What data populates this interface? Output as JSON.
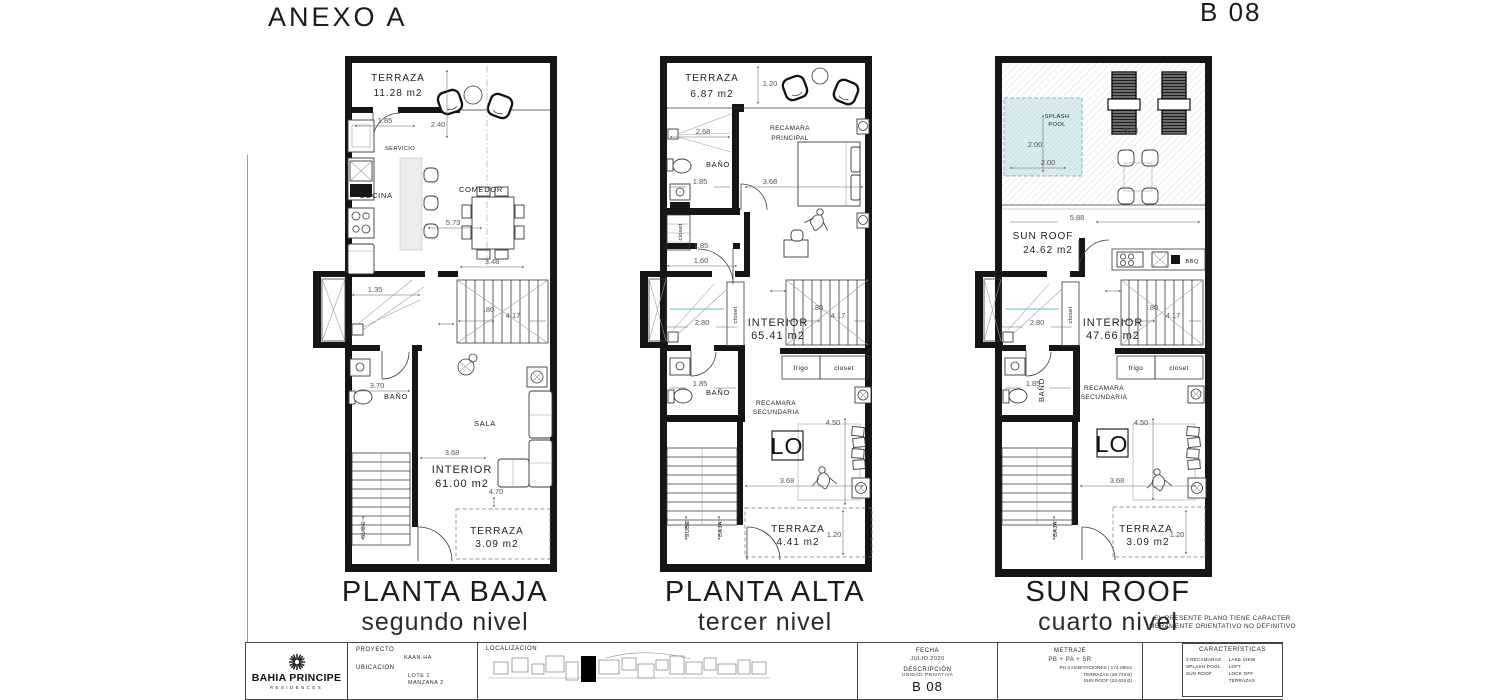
{
  "header": {
    "title": "ANEXO A",
    "unit": "B 08"
  },
  "p1": {
    "title": "PLANTA BAJA",
    "subtitle": "segundo nivel",
    "terraza": "TERRAZA",
    "terraza_area": "11.28 m2",
    "d185": "1.85",
    "d240": "2.40",
    "servicio": "SERVICIO",
    "cocina": "COCINA",
    "comedor": "COMEDOR",
    "d573": "5.73",
    "d348": "3.48",
    "d135": "1.35",
    "d80": ".80",
    "d417": "4.17",
    "d370": "3.70",
    "bano": "BAÑO",
    "sala": "SALA",
    "d368": "3.68",
    "interior": "INTERIOR",
    "interior_area": "61.00 m2",
    "d470": "4.70",
    "terraza2": "TERRAZA",
    "terraza2_area": "3.09 m2",
    "sube": "SUBE"
  },
  "p2": {
    "title": "PLANTA ALTA",
    "subtitle": "tercer nivel",
    "terraza": "TERRAZA",
    "terraza_area": "6.87 m2",
    "d120": "1.20",
    "recamara_a": "RECAMARA",
    "recamara_b": "PRINCIPAL",
    "d268": "2.68",
    "bano": "BAÑO",
    "d185": "1.85",
    "d368": "3.68",
    "closet_v": "closet",
    "d185b": "1.85",
    "d160": "1.60",
    "d280": "2.80",
    "closet_v2": "closet",
    "interior": "INTERIOR",
    "interior_area": "65.41 m2",
    "d80": ".80",
    "d417": "4.17",
    "frigo": "frigo",
    "closet": "closet",
    "d185c": "1.85",
    "bano2": "BAÑO",
    "recamara2_a": "RECAMARA",
    "recamara2_b": "SECUNDARIA",
    "d450": "4.50",
    "lo": "LO",
    "d368b": "3.68",
    "terraza2": "TERRAZA",
    "terraza2_area": "4.41 m2",
    "d120b": "1.20",
    "sube": "SUBE",
    "baja": "BAJA"
  },
  "p3": {
    "title": "SUN ROOF",
    "subtitle": "cuarto nivel",
    "splash_a": "SPLASH",
    "splash_b": "POOL",
    "d200a": "2.00",
    "d200b": "2.00",
    "d573": "5.73",
    "d588": "5.88",
    "sunroof": "SUN ROOF",
    "sunroof_area": "24.62 m2",
    "bbq": "BBQ",
    "d280": "2.80",
    "closet_v": "closet",
    "interior": "INTERIOR",
    "interior_area": "47.66 m2",
    "d80": ".80",
    "d417": "4.17",
    "frigo": "frigo",
    "closet": "closet",
    "d185": "1.85",
    "bano": "BAÑO",
    "recamara_a": "RECAMARA",
    "recamara_b": "SECUNDARIA",
    "d450": "4.50",
    "lo": "LO",
    "d368": "3.68",
    "terraza": "TERRAZA",
    "terraza_area": "3.09 m2",
    "d120": "1.20",
    "baja": "BAJA"
  },
  "disclaimer": {
    "line1": "EL PRESENTE PLANO TIENE CARACTER",
    "line2": "MERAMENTE ORIENTATIVO NO DEFINITIVO"
  },
  "tb": {
    "brand": {
      "name": "BAHIA PRINCIPE",
      "sub": "RESIDENCES"
    },
    "proyecto": {
      "label": "PROYECTO",
      "value": "KAAN-HA"
    },
    "ubicacion": {
      "label": "UBICACION",
      "line1": "LOTE 1",
      "line2": "MANZANA 2"
    },
    "localizacion": {
      "label": "LOCALIZACION"
    },
    "fecha": {
      "label": "FECHA",
      "value": "JULIO.2020"
    },
    "descripcion": {
      "label": "DESCRIPCIÓN",
      "sub": "UNIDAD PRIVATIVA",
      "value": "B 08"
    },
    "metraje": {
      "label": "METRAJE",
      "formula": "PB + PA + SR",
      "line1": "PH 3 HABITACIONES | 174.09m2",
      "line2": "TERRAZAS (28.74m2)",
      "line3": "SUN ROOF (24.62m2)"
    },
    "caract": {
      "label": "CARACTERÍSTICAS",
      "col1": [
        "3 RECAMARAS",
        "SPLASH POOL",
        "SUN ROOF"
      ],
      "col2": [
        "LAKE VIEW",
        "LOFT",
        "LOCK OFF",
        "TERRAZAS"
      ]
    }
  }
}
